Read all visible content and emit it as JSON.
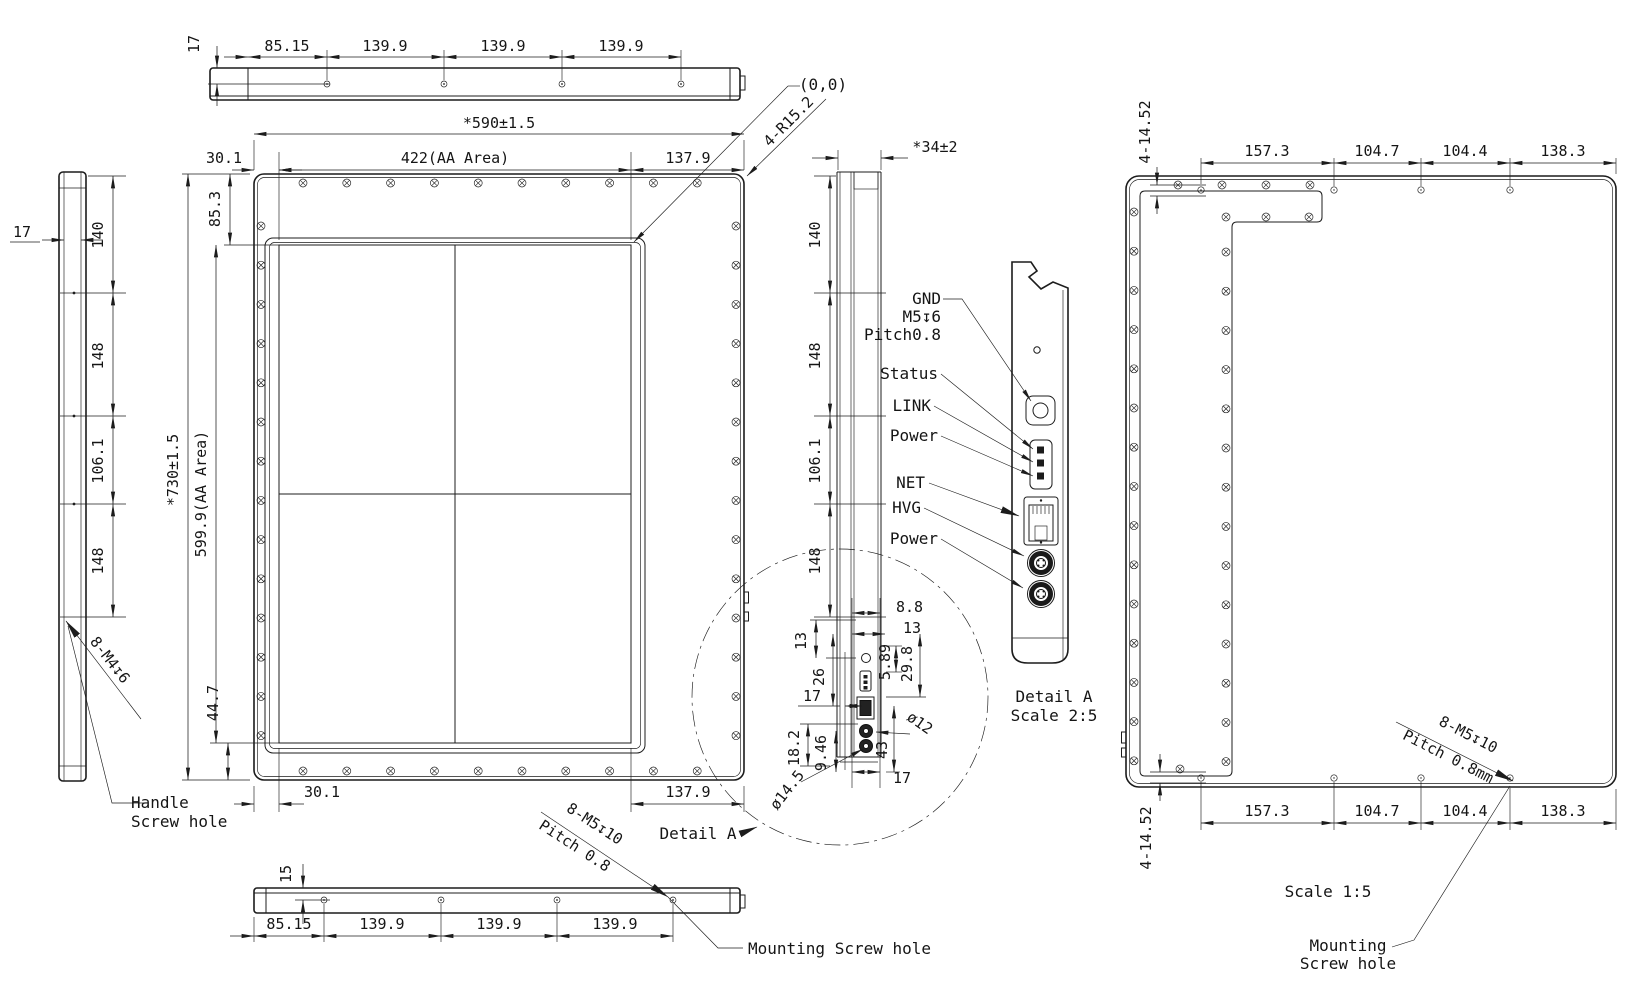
{
  "front_view": {
    "overall_width": "*590±1.5",
    "aa_width": "422(AA Area)",
    "left_offset": "30.1",
    "right_offset": "137.9",
    "top_offset": "85.3",
    "overall_height": "*730±1.5",
    "aa_height": "599.9(AA Area)",
    "bottom_offset": "44.7",
    "bottom_left_offset": "30.1",
    "bottom_right_offset": "137.9",
    "origin_label": "(0,0)",
    "corner_radius_spec": "4-R15.2"
  },
  "top_view": {
    "thickness": "17",
    "pitch": [
      "85.15",
      "139.9",
      "139.9",
      "139.9"
    ]
  },
  "left_view": {
    "thickness": "17",
    "pitch": [
      "140",
      "148",
      "106.1",
      "148"
    ],
    "handle_tap_spec": "8-M4↧6",
    "handle_label": [
      "Handle",
      "Screw hole"
    ]
  },
  "bottom_view": {
    "hole_offset": "15",
    "pitch": [
      "85.15",
      "139.9",
      "139.9",
      "139.9"
    ],
    "tap_spec": [
      "8-M5↧10",
      "Pitch 0.8"
    ],
    "mounting_label": "Mounting Screw hole",
    "detail_callout": "Detail A"
  },
  "side_view": {
    "overall_depth": "*34±2",
    "pitch": [
      "140",
      "148",
      "106.1",
      "148"
    ]
  },
  "detail_circle": {
    "dims": [
      "8.8",
      "13",
      "13",
      "26",
      "17",
      "5.89",
      "29.8",
      "18.2",
      "9.46",
      "43",
      "ø12",
      "ø14.5",
      "17"
    ]
  },
  "ports": {
    "gnd": "GND",
    "gnd_thread": "M5↧6",
    "gnd_pitch": "Pitch0.8",
    "status": "Status",
    "link": "LINK",
    "power_led": "Power",
    "net": "NET",
    "hvg": "HVG",
    "power_in": "Power"
  },
  "detail_view": {
    "title": "Detail A",
    "scale": "Scale 2:5"
  },
  "rear_view": {
    "hole_spec_top": "4-14.52",
    "hole_spec_bottom": "4-14.52",
    "pitch_top": [
      "157.3",
      "104.7",
      "104.4",
      "138.3"
    ],
    "pitch_bottom": [
      "157.3",
      "104.7",
      "104.4",
      "138.3"
    ],
    "tap_spec": [
      "8-M5↧10",
      "Pitch 0.8mm"
    ],
    "scale": "Scale 1:5",
    "mounting_label": [
      "Mounting",
      "Screw hole"
    ]
  },
  "colors": {
    "line": "#1c1c1c",
    "bg": "#ffffff"
  }
}
